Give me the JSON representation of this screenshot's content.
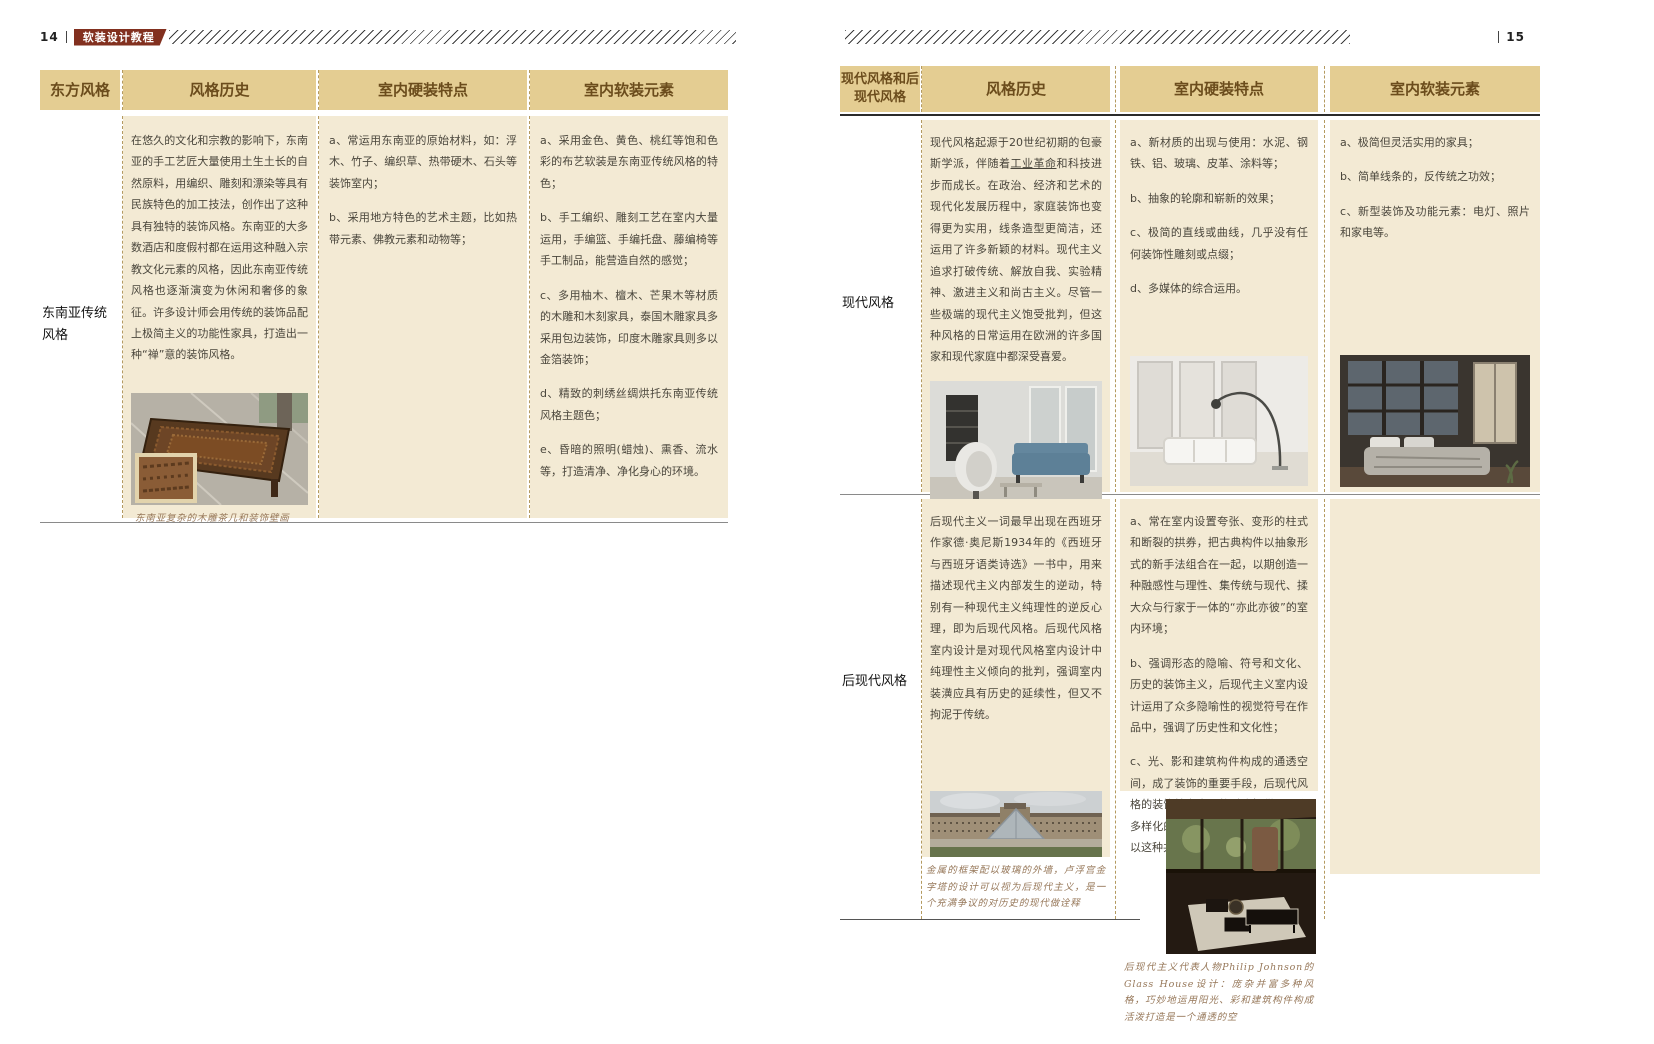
{
  "colors": {
    "header_bg": "#e4cd92",
    "cell_bg": "#f3ead4",
    "badge_bg": "#82301f",
    "header_text": "#6b4c1c"
  },
  "left": {
    "page_number": "14",
    "book_title": "软装设计教程",
    "headers": [
      "东方风格",
      "风格历史",
      "室内硬装特点",
      "室内软装元素"
    ],
    "row": {
      "label": "东南亚传统风格",
      "history": "在悠久的文化和宗教的影响下，东南亚的手工艺匠大量使用土生土长的自然原料，用编织、雕刻和漂染等具有民族特色的加工技法，创作出了这种具有独特的装饰风格。东南亚的大多数酒店和度假村都在运用这种融入宗教文化元素的风格，因此东南亚传统风格也逐渐演变为休闲和奢侈的象征。许多设计师会用传统的装饰品配上极简主义的功能性家具，打造出一种“禅”意的装饰风格。",
      "hard": [
        "a、常运用东南亚的原始材料，如：浮木、竹子、编织草、热带硬木、石头等装饰室内；",
        "b、采用地方特色的艺术主题，比如热带元素、佛教元素和动物等；"
      ],
      "soft": [
        "a、采用金色、黄色、桃红等饱和色彩的布艺软装是东南亚传统风格的特色；",
        "b、手工编织、雕刻工艺在室内大量运用，手编篮、手编托盘、藤编椅等手工制品，能营造自然的感觉；",
        "c、多用柚木、檀木、芒果木等材质的木雕和木刻家具，泰国木雕家具多采用包边装饰，印度木雕家具则多以金箔装饰；",
        "d、精致的刺绣丝绸烘托东南亚传统风格主题色；",
        "e、昏暗的照明(蜡烛)、熏香、流水等，打造清净、净化身心的环境。"
      ],
      "photo_caption": "东南亚复杂的木雕茶几和装饰壁画"
    }
  },
  "right": {
    "page_number": "15",
    "headers": [
      "现代风格和后现代风格",
      "风格历史",
      "室内硬装特点",
      "室内软装元素"
    ],
    "modern": {
      "label": "现代风格",
      "history_pre": "现代风格起源于20世纪初期的包豪斯学派，伴随着",
      "history_term": "工业革命",
      "history_post": "和科技进步而成长。在政治、经济和艺术的现代化发展历程中，家庭装饰也变得更为实用，线条造型更简洁，还运用了许多新颖的材料。现代主义追求打破传统、解放自我、实验精神、激进主义和尚古主义。尽管一些极端的现代主义饱受批判，但这种风格的日常运用在欧洲的许多国家和现代家庭中都深受喜爱。",
      "hard": [
        "a、新材质的出现与使用：水泥、钢铁、铝、玻璃、皮革、涂料等；",
        "b、抽象的轮廓和崭新的效果；",
        "c、极简的直线或曲线，几乎没有任何装饰性雕刻或点缀；",
        "d、多媒体的综合运用。"
      ],
      "soft": [
        "a、极简但灵活实用的家具；",
        "b、简单线条的，反传统之功效；",
        "c、新型装饰及功能元素：电灯、照片和家电等。"
      ]
    },
    "postmodern": {
      "label": "后现代风格",
      "history": "后现代主义一词最早出现在西班牙作家德·奥尼斯1934年的《西班牙与西班牙语类诗选》一书中，用来描述现代主义内部发生的逆动，特别有一种现代主义纯理性的逆反心理，即为后现代风格。后现代风格室内设计是对现代风格室内设计中纯理性主义倾向的批判，强调室内装潢应具有历史的延续性，但又不拘泥于传统。",
      "hard": [
        "a、常在室内设置夸张、变形的柱式和断裂的拱券，把古典构件以抽象形式的新手法组合在一起，以期创造一种融感性与理性、集传统与现代、揉大众与行家于一体的“亦此亦彼”的室内环境；",
        "b、强调形态的隐喻、符号和文化、历史的装饰主义，后现代主义室内设计运用了众多隐喻性的视觉符号在作品中，强调了历史性和文化性；",
        "c、光、影和建筑构件构成的通透空间，成了装饰的重要手段，后现代风格的装饰性为多风格融合提供了一个多样化的环境，使不同的风貌并存，以这种共享关系贴近居住者的习俗。"
      ],
      "louvre_caption": "金属的框架配以玻璃的外墙，卢浮宫金字塔的设计可以视为后现代主义，是一个充满争议的对历史的现代做诠释",
      "glasshouse_caption": "后现代主义代表人物Philip Johnson的Glass House设计：庞杂并富多种风格，巧妙地运用阳光、彩和建筑构件构成活泼打造是一个通透的空"
    }
  }
}
